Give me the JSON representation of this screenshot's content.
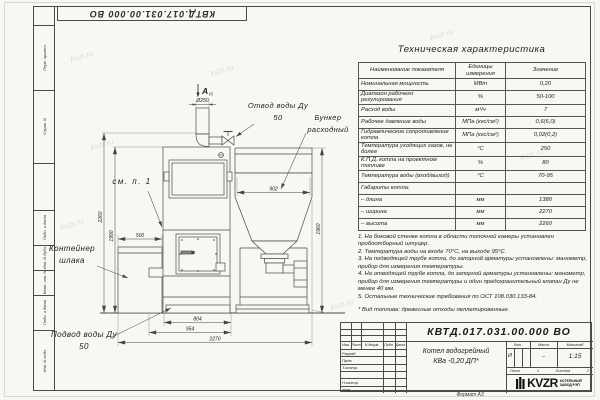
{
  "watermark": {
    "text": "kvzr.ru"
  },
  "frame": {
    "top_stamp": "КВТД.017.031.00.000 ВО",
    "left_fields": {
      "perv_primen": "Перв. примен.",
      "sprav_n": "Справ. N",
      "podp_data_1": "Подп. и дата",
      "inv_dubl": "Инв. N дубл.",
      "vzam_inv": "Взам. инв. N",
      "podp_data_2": "Подп. и дата",
      "inv_podl": "Инв. N подл."
    },
    "format_note": "Формат А3"
  },
  "tech_table": {
    "title": "Техническая характеристика",
    "headers": {
      "name": "Наименование показателя",
      "units": "Единицы измерения",
      "value": "Значение"
    },
    "rows": [
      {
        "name": "Номинальная мощность",
        "units": "МВт",
        "value": "0,20"
      },
      {
        "name": "Диапазон рабочего регулирования",
        "units": "%",
        "value": "50-100"
      },
      {
        "name": "Расход воды",
        "units": "м³/ч",
        "value": "7"
      },
      {
        "name": "Рабочее давление воды",
        "units": "МПа (кгс/см²)",
        "value": "0,6(6,0)"
      },
      {
        "name": "Гидравлическое сопротивление котла",
        "units": "МПа (кгс/см²)",
        "value": "0,02(0,2)"
      },
      {
        "name": "Температура уходящих газов, не более",
        "units": "°С",
        "value": "250"
      },
      {
        "name": "К.П.Д. котла на проектном топливе",
        "units": "%",
        "value": "80"
      },
      {
        "name": "Температура воды (вход/выход)",
        "units": "°С",
        "value": "70-95"
      },
      {
        "name": "Габариты котла:",
        "units": "",
        "value": ""
      },
      {
        "name": "– длина",
        "units": "мм",
        "value": "1380"
      },
      {
        "name": "– ширина",
        "units": "мм",
        "value": "2270"
      },
      {
        "name": "– высота",
        "units": "мм",
        "value": "2260"
      }
    ]
  },
  "notes": {
    "n1": "1. На боковой стенке котла в области топочной камеры установлен пробоотборный штуцер.",
    "n2": "2. Температура воды на входе 70°С, на выходе 95°С.",
    "n3": "3. На подводящей трубе котла, до запорной арматуры установлены: манометр, прибор для измерения температуры.",
    "n4": "4. На отводящей трубе котла, до запорной арматуры установлены: манометр, прибор для измерения температуры и один предохранительный клапан Ду не менее 40 мм.",
    "n5": "5. Остальные технические требования по ОСТ 108.030.133-84.",
    "fuel": "* Вид топлива: древесные отходы пеллетированные."
  },
  "drawing": {
    "view_label": "A",
    "view_sub": "(2)",
    "labels": {
      "otvod": "Отвод воды Ду 50",
      "bunker": "Бункер расходный",
      "sm_p1": "см. п. 1",
      "konteiner": "Контейнер шлака",
      "podvod": "Подвод воды Ду 50"
    },
    "dims": {
      "d250": "Ø250",
      "d902": "902",
      "d500": "500",
      "d804": "804",
      "d954": "954",
      "d2270": "2270",
      "d2260": "2260",
      "d1990": "1990",
      "d1960": "1960"
    }
  },
  "title_block": {
    "doc_number": "КВТД.017.031.00.000 ВО",
    "product_name_1": "Котел водогрейный",
    "product_name_2": "КВа -0,20  ДП*",
    "header_cols": {
      "izm": "Изм.",
      "list": "Лист",
      "doc": "N докум.",
      "podp": "Подп.",
      "data": "Дата"
    },
    "rows": {
      "razrab": "Разраб.",
      "prov": "Пров.",
      "tkontr": "Т.контр.",
      "nkontr": "Н.контр.",
      "utv": "Утв."
    },
    "lit_header": "Лит.",
    "massa_header": "Масса",
    "masshtab_header": "Масштаб",
    "lit_value": "И",
    "massa_value": "–",
    "masshtab_value": "1:15",
    "list_label": "Лист",
    "list_value": "1",
    "listov_label": "Листов",
    "listov_value": "2",
    "logo_text": "KVZR",
    "logo_caption_1": "КОТЕЛЬНЫЙ",
    "logo_caption_2": "ЗАВОД РЭП"
  }
}
